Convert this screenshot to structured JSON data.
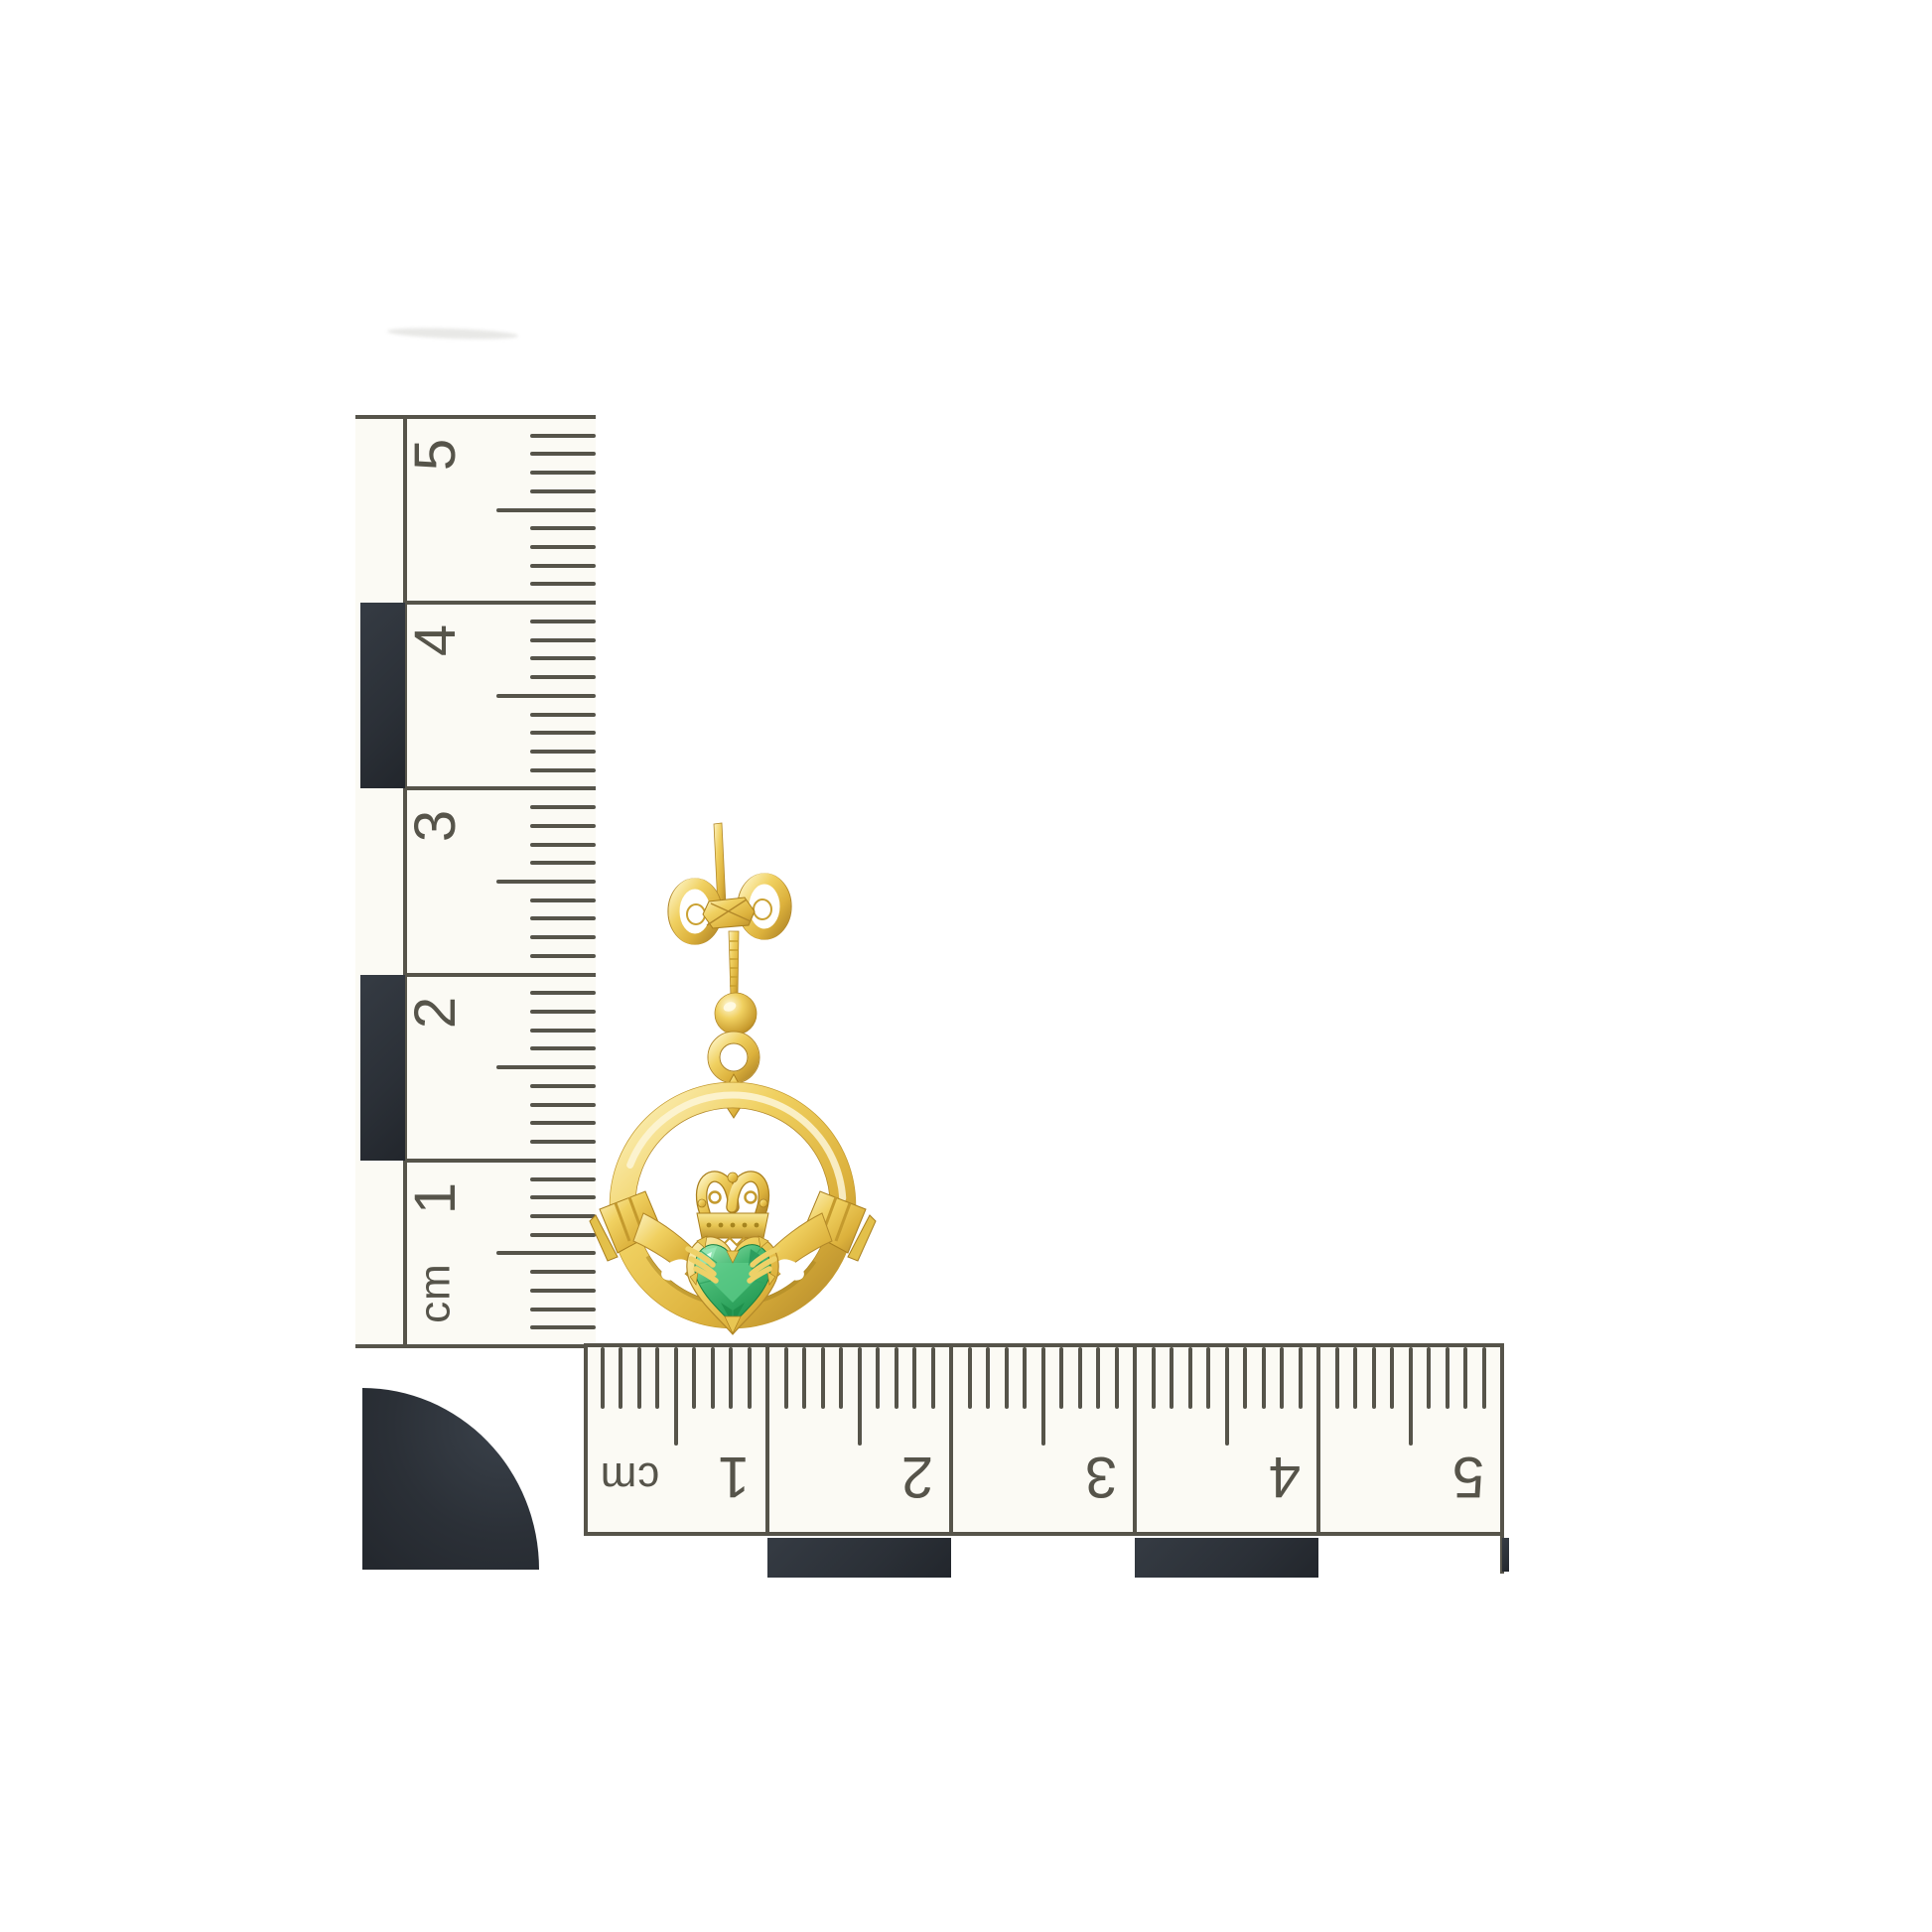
{
  "scene": {
    "background_color": "#ffffff"
  },
  "vertical_ruler": {
    "unit_label": "cm",
    "labels": [
      "5",
      "4",
      "3",
      "2",
      "1"
    ],
    "ticks_per_cm": 10,
    "print_color": "#56544a",
    "block_color": "#2b3037",
    "body_color": "#fbfaf4"
  },
  "horizontal_ruler": {
    "unit_label": "cm",
    "labels": [
      "1",
      "2",
      "3",
      "4",
      "5"
    ],
    "ticks_per_cm": 10,
    "print_color": "#56544a",
    "block_color": "#2b3037",
    "body_color": "#fbfaf4"
  },
  "corner_marker": {
    "color": "#2b3037"
  },
  "earring": {
    "gold_base": "#e8c653",
    "gold_highlight": "#fdf3c2",
    "gold_shadow": "#b3892a",
    "gem_base": "#3db36c",
    "gem_highlight": "#8fe0a9",
    "gem_shadow": "#1d8c49"
  }
}
